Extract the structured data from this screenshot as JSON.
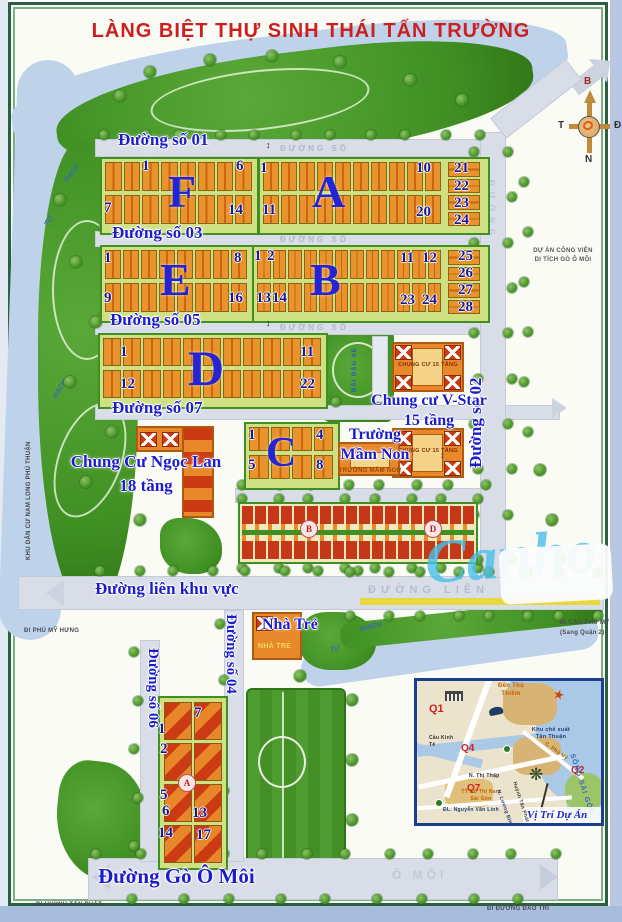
{
  "title": "LÀNG BIỆT THỰ SINH THÁI TẤN TRƯỜNG",
  "colors": {
    "title_red": "#cc2020",
    "label_blue": "#1c1ccc",
    "number_navy": "#181890",
    "letter_blue": "#2424d4",
    "road_gray": "#d9dde7",
    "water_blue": "#bed3ea",
    "park_green": "#3f8f23",
    "block_yellow": "#cfe082",
    "lot_orange": "#e0801f",
    "roof_red": "#c43818"
  },
  "roads": {
    "d01": "Đường số 01",
    "d03": "Đường số 03",
    "d05": "Đường số 05",
    "d07": "Đường số 07",
    "d02": "Đường số 02",
    "d04": "Đường số 04",
    "d06": "Đường số 06",
    "lien": "Đường liên khu vực",
    "go_o_moi": "Đường Gò Ô Môi"
  },
  "surface": {
    "duong_so": "ĐƯỜNG SỐ",
    "lien": "ĐƯỜNG LIÊN",
    "o_moi": "Ô MÔI",
    "duong": "ĐƯỜNG"
  },
  "blocks": [
    {
      "letter": "F",
      "numbers": [
        "1",
        "6",
        "7",
        "14"
      ]
    },
    {
      "letter": "A",
      "numbers": [
        "1",
        "10",
        "11",
        "20",
        "21",
        "22",
        "23",
        "24"
      ]
    },
    {
      "letter": "E",
      "numbers": [
        "1",
        "8",
        "9",
        "16"
      ]
    },
    {
      "letter": "B",
      "numbers": [
        "1",
        "2",
        "11",
        "12",
        "13",
        "14",
        "23",
        "24",
        "25",
        "26",
        "27",
        "28"
      ]
    },
    {
      "letter": "D",
      "numbers": [
        "1",
        "11",
        "12",
        "22"
      ]
    },
    {
      "letter": "C",
      "numbers": [
        "1",
        "4",
        "5",
        "8"
      ]
    },
    {
      "letter": "A",
      "numbers": [
        "7",
        "1",
        "2",
        "5",
        "6",
        "13",
        "14",
        "17"
      ]
    }
  ],
  "townhouses": {
    "circles": [
      "B",
      "D"
    ]
  },
  "facilities": {
    "ngoc_lan_1": "Chung Cư Ngọc Lan",
    "ngoc_lan_2": "18 tầng",
    "v_star_1": "Chung cư V-Star",
    "v_star_2": "15 tầng",
    "cc15": "CHUNG CƯ 15 TẦNG",
    "mam_non_1": "Trường",
    "mam_non_2": "Mầm Non",
    "mam_non_small": "TRƯỜNG MẦM NON",
    "nha_tre": "Nhà Trẻ",
    "nha_tre_small": "NHÀ TRẺ",
    "bai_dau_xe": "BÃI ĐẬU XE"
  },
  "exits": {
    "phu_my_hung": "ĐI PHÚ MỸ HƯNG",
    "cau_phu_my_1": "ĐI CẦU PHÚ MỸ",
    "cau_phu_my_2": "(Sang Quận 2)",
    "huynh_tan_phat": "ĐI HUỲNH TẤN PHÁT",
    "dao_tri": "ĐI ĐƯỜNG ĐÀO TRÍ"
  },
  "areas": {
    "cong_vien_1": "DỰ ÁN CÔNG VIÊN",
    "cong_vien_2": "DI TÍCH GÒ Ô MÔI",
    "nam_long": "KHU DÂN CƯ NAM LONG PHÚ THUẬN",
    "rach": "RẠCH",
    "tu": "TỰ",
    "nhien": "NHIÊN"
  },
  "compass": {
    "n": "B",
    "e": "Đ",
    "s": "N",
    "w": "T"
  },
  "watermark": "Canho",
  "inset": {
    "title": "Vị Trí Dự Án",
    "districts": [
      "Q1",
      "Q4",
      "Q7",
      "Q2"
    ],
    "labels": {
      "den": "Đền Thủ Thiêm",
      "kcx": "Khu chế xuất Tân Thuận",
      "cau_kinh_te": "Cầu Kinh Tẻ",
      "thi_thap": "N. Thị Thập",
      "tt_do_thi": "TT Đô Thị Nam Sài Gòn",
      "nvl": "ĐL. Nguyễn Văn Linh",
      "song": "SÔNG SÀI GÒN",
      "htp": "Huỳnh Tấn Phát",
      "phu_my": "C. Phú Mỹ",
      "luong": "N. Lương Định Của"
    }
  }
}
